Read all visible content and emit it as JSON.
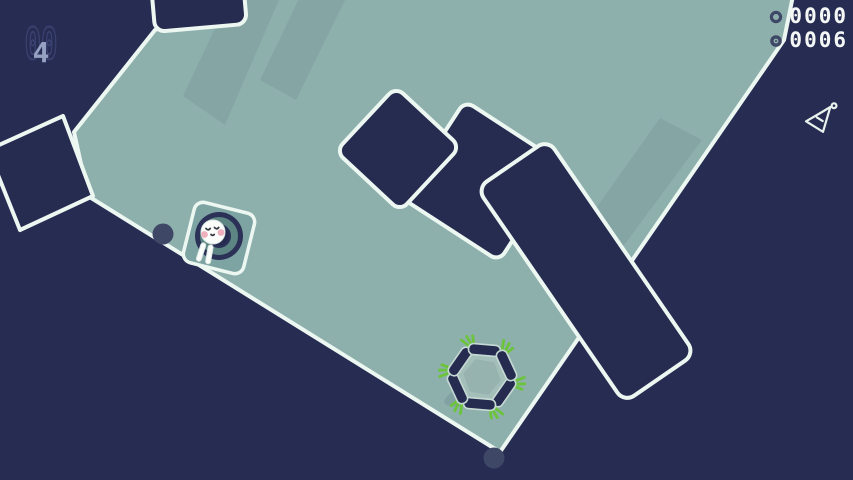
{
  "hud": {
    "level": {
      "ghost": "00",
      "value": "4"
    },
    "counters": [
      {
        "icon": "coin-ring-icon",
        "value": "0000"
      },
      {
        "icon": "collectible-dot-icon",
        "value": "0006"
      }
    ],
    "pickup_indicator_icon": "flask-flag-icon"
  },
  "scene": {
    "player": "bunny-in-hole",
    "collectible_cluster": "carrot-ring",
    "carrot_count": 6,
    "edge_dot_count": 2,
    "obstacle_count": 5
  },
  "palette": {
    "background": "#272c52",
    "terrain": "#8eb0ad",
    "outline": "#edf7f2",
    "obstacle": "#262b50",
    "player_square": "#7da4a2",
    "hole_navy": "#2b3157",
    "hole_ring": "#5c8583",
    "leaf_green": "#6cc33c",
    "cheek_pink": "#eeb0bf",
    "dot_slate": "#3e4866",
    "hud_text": "#f4f7f5",
    "hud_ghost": "#3a4170",
    "level_text": "#96a1c1"
  }
}
